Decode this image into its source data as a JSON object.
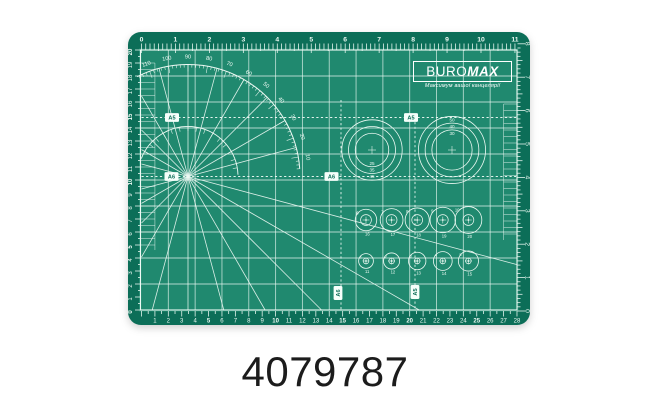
{
  "product_code": "4079787",
  "colors": {
    "mat_border": "#0c6e58",
    "mat_surface": "#20896F",
    "markings": "#eefaf4",
    "grid": "#c4e4d8",
    "badge_bg": "#f6fffb",
    "badge_text": "#0c6e58",
    "logo_text": "#ffffff",
    "code_text": "#1c1c1c"
  },
  "logo": {
    "brand_regular": "BURO",
    "brand_bold": "MAX",
    "slogan": "Максимум вашої канцелярії"
  },
  "rulers": {
    "top_inches": [
      "0",
      "1",
      "2",
      "3",
      "4",
      "5",
      "6",
      "7",
      "8",
      "9",
      "10",
      "11"
    ],
    "bottom_cm": [
      "1",
      "2",
      "3",
      "4",
      "5",
      "6",
      "7",
      "8",
      "9",
      "10",
      "11",
      "12",
      "13",
      "14",
      "15",
      "16",
      "17",
      "18",
      "19",
      "20",
      "21",
      "22",
      "23",
      "24",
      "25",
      "26",
      "27",
      "28"
    ],
    "left_cm": [
      "0",
      "1",
      "2",
      "3",
      "4",
      "5",
      "6",
      "7",
      "8",
      "9",
      "10",
      "11",
      "12",
      "13",
      "14",
      "15",
      "16",
      "17",
      "18",
      "19",
      "20"
    ],
    "right_inches": [
      "0",
      "1",
      "2",
      "3",
      "4",
      "5",
      "6",
      "7",
      "8"
    ]
  },
  "protractor_labels": [
    "10",
    "20",
    "30",
    "40",
    "50",
    "60",
    "70",
    "80",
    "90",
    "100",
    "110"
  ],
  "size_badges": [
    "A5",
    "A5",
    "A6",
    "A6",
    "A6",
    "A5"
  ],
  "circle_gauges": {
    "left_dial_mm": [
      "25",
      "35",
      "45"
    ],
    "right_dial_mm": [
      "50",
      "40",
      "30"
    ],
    "top_row": {
      "numbers": [
        "6",
        "7",
        "8",
        "9",
        "10"
      ],
      "diameters": [
        "16",
        "17",
        "18",
        "19",
        "20"
      ]
    },
    "bottom_row": {
      "numbers": [
        "1",
        "2",
        "3",
        "4",
        "5"
      ],
      "diameters": [
        "11",
        "12",
        "13",
        "14",
        "15"
      ]
    }
  }
}
